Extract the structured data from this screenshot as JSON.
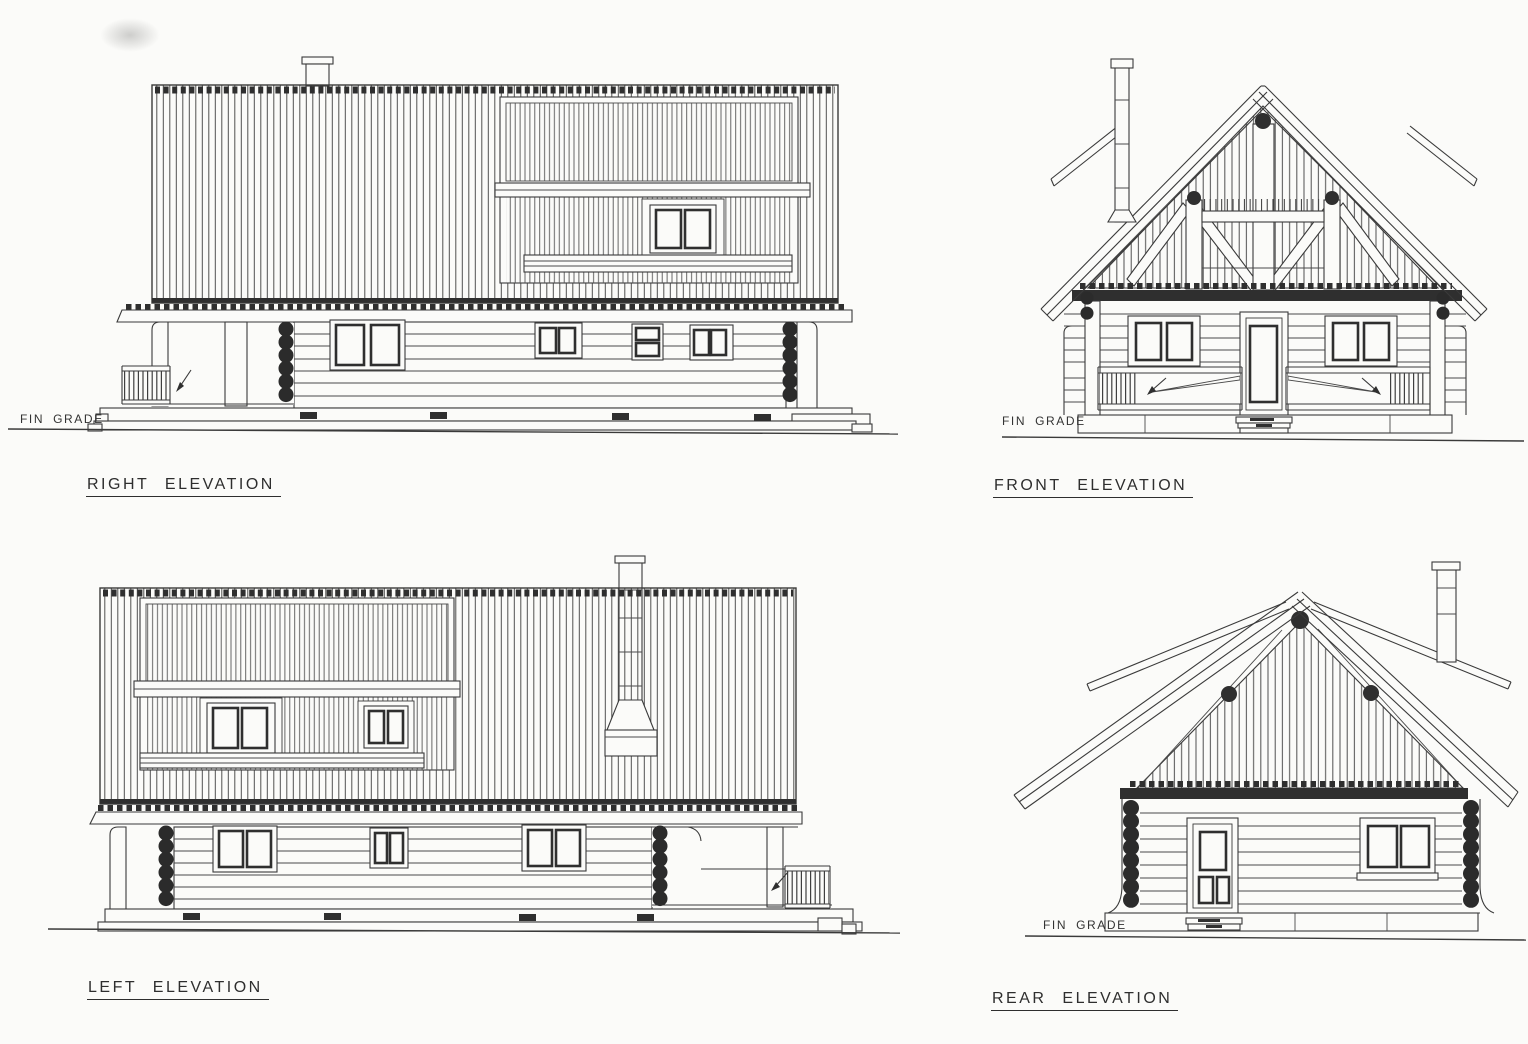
{
  "drawing": {
    "paper_color": "#fbfbf9",
    "ink_color": "#3a3a3a",
    "views": {
      "right": {
        "title": "RIGHT ELEVATION",
        "fin_grade": "FIN GRADE"
      },
      "front": {
        "title": "FRONT ELEVATION",
        "fin_grade": "FIN GRADE"
      },
      "left": {
        "title": "LEFT ELEVATION"
      },
      "rear": {
        "title": "REAR ELEVATION",
        "fin_grade": "FIN GRADE"
      }
    }
  }
}
